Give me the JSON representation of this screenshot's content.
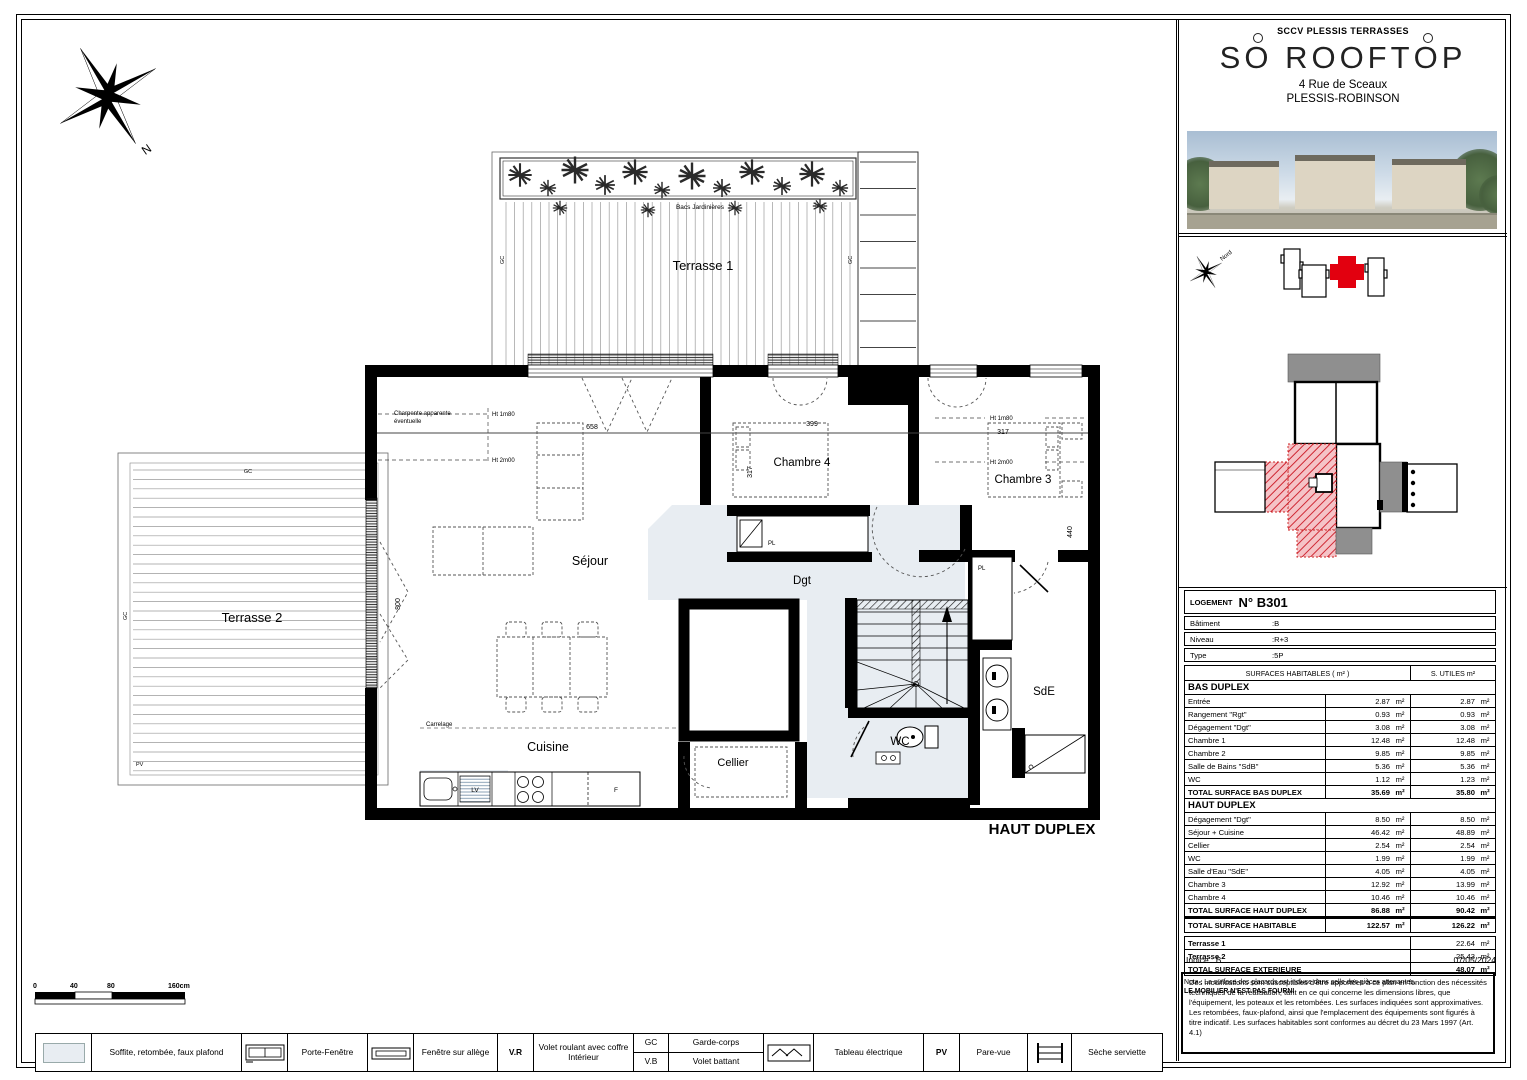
{
  "title_block": {
    "company": "SCCV PLESSIS TERRASSES",
    "logo": {
      "p1": "S",
      "o1": "O",
      "p2": "ROOFT",
      "o2": "O",
      "p3": "P"
    },
    "address1": "4 Rue de Sceaux",
    "address2": "PLESSIS-ROBINSON"
  },
  "key_plan": {
    "north": "Nord"
  },
  "unit": {
    "header_label": "LOGEMENT",
    "header_no": "N° B301",
    "info": [
      {
        "label": "Bâtiment",
        "value": ":B"
      },
      {
        "label": "Niveau",
        "value": ":R+3"
      },
      {
        "label": "Type",
        "value": ":5P"
      }
    ],
    "col_left": "SURFACES HABITABLES ( m² )",
    "col_right": "S. UTILES  m²",
    "unit_symbol": "m²",
    "bas": {
      "title": "BAS DUPLEX",
      "rows": [
        [
          "Entrée",
          "2.87",
          "2.87"
        ],
        [
          "Rangement \"Rgt\"",
          "0.93",
          "0.93"
        ],
        [
          "Dégagement \"Dgt\"",
          "3.08",
          "3.08"
        ],
        [
          "Chambre 1",
          "12.48",
          "12.48"
        ],
        [
          "Chambre 2",
          "9.85",
          "9.85"
        ],
        [
          "Salle de Bains \"SdB\"",
          "5.36",
          "5.36"
        ],
        [
          "WC",
          "1.12",
          "1.23"
        ]
      ],
      "total": [
        "TOTAL SURFACE BAS DUPLEX",
        "35.69",
        "35.80"
      ]
    },
    "haut": {
      "title": "HAUT DUPLEX",
      "rows": [
        [
          "Dégagement \"Dgt\"",
          "8.50",
          "8.50"
        ],
        [
          "Séjour + Cuisine",
          "46.42",
          "48.89"
        ],
        [
          "Cellier",
          "2.54",
          "2.54"
        ],
        [
          "WC",
          "1.99",
          "1.99"
        ],
        [
          "Salle d'Eau \"SdE\"",
          "4.05",
          "4.05"
        ],
        [
          "Chambre 3",
          "12.92",
          "13.99"
        ],
        [
          "Chambre 4",
          "10.46",
          "10.46"
        ]
      ],
      "total": [
        "TOTAL SURFACE HAUT DUPLEX",
        "86.88",
        "90.42"
      ]
    },
    "grand": [
      "TOTAL SURFACE HABITABLE",
      "122.57",
      "126.22"
    ],
    "ext_rows": [
      [
        "Terrasse 1",
        "22.64"
      ],
      [
        "Terrasse 2",
        "25.43"
      ]
    ],
    "ext_total": [
      "TOTAL SURFACE EXTERIEURE",
      "48.07"
    ],
    "note1": "Nota : La surface des placards est incluse dans celle des pièces attenantes.",
    "note2": "LE MOBILIER N'EST PAS FOURNI"
  },
  "plan": {
    "title": "HAUT DUPLEX",
    "terrasse1": "Terrasse 1",
    "terrasse2": "Terrasse 2",
    "sejour": "Séjour",
    "cuisine": "Cuisine",
    "cellier": "Cellier",
    "chambre4": "Chambre 4",
    "chambre3": "Chambre 3",
    "dgt": "Dgt",
    "sde": "SdE",
    "wc": "WC",
    "bacs": "Bacs Jardinières",
    "charpente1": "Charpente apparente",
    "charpente2": "éventuelle",
    "ht180": "Ht 1m80",
    "ht200": "Ht 2m00",
    "carrelage": "Carrelage",
    "lv": "LV",
    "f": "F",
    "pl": "PL",
    "gc": "GC",
    "pv": "PV",
    "d658": "658",
    "d399": "399",
    "d317": "317",
    "d800": "800",
    "d440": "440",
    "north": "N"
  },
  "scale_bar": {
    "t0": "0",
    "t1": "40",
    "t2": "80",
    "t3": "160cm"
  },
  "legend": {
    "soffite": "Soffite, retombée, faux plafond",
    "porte": "Porte-Fenêtre",
    "fenetre": "Fenêtre sur allège",
    "vr": "V.R",
    "vr_label": "Volet roulant avec coffre Intérieur",
    "gc": "GC",
    "gc_label": "Garde-corps",
    "vb": "V.B",
    "vb_label": "Volet battant",
    "te_label": "Tableau électrique",
    "pv": "PV",
    "pv_label": "Pare-vue",
    "ss_label": "Sèche serviette"
  },
  "footer": {
    "indice": "Indice : B",
    "date": "07/05/2024",
    "disclaimer": "Des modifications sont susceptibles d'être apportées à ce plan en fonction des nécessités techniques de la réalisation, tant en ce qui concerne les dimensions libres, que l'équipement, les poteaux et les retombées. Les surfaces indiquées sont approximatives. Les retombées, faux-plafond, ainsi que l'emplacement des équipements sont figurés à titre indicatif. Les surfaces habitables sont conformes au décret du 23 Mars 1997 (Art. 4.1)"
  },
  "colors": {
    "accent_red": "#e2000f",
    "shade": "#e8edf2",
    "wall": "#000000",
    "key_gray": "#8f8f8f"
  }
}
